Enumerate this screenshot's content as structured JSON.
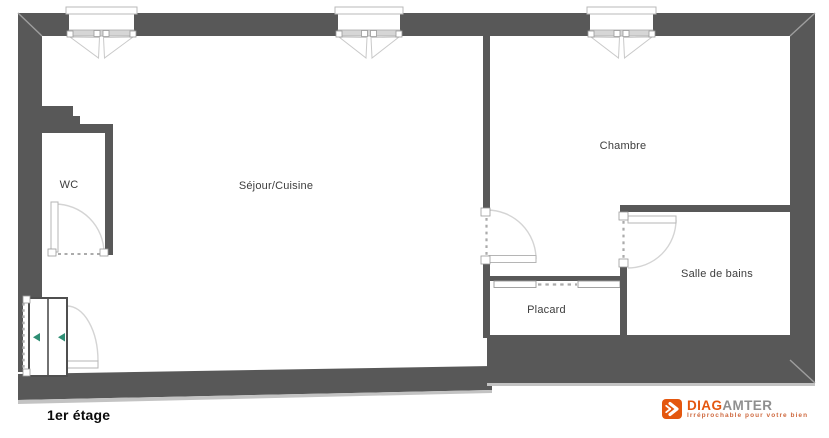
{
  "floor_plan": {
    "floor_label": "1er étage",
    "rooms": [
      {
        "name": "WC"
      },
      {
        "name": "Séjour/Cuisine"
      },
      {
        "name": "Chambre"
      },
      {
        "name": "Placard"
      },
      {
        "name": "Salle de bains"
      }
    ]
  },
  "logo": {
    "icon": "double-chevron-right-icon",
    "brand_part1": "DIAG",
    "brand_part2": "AMTER",
    "tagline": "Irréprochable pour votre bien"
  },
  "colors": {
    "wall": "#585858",
    "wall_bevel": "#9e9e9e",
    "door_swing_line": "#d4d4d4",
    "door_leaf_border": "#b5b5b5",
    "opening_dash": "#ababab",
    "window_bar": "#d6d6d6",
    "entrance_arrow_green": "#2e8e74",
    "room_label_text": "#3d3d3d",
    "brand_orange": "#e4570f",
    "brand_gray": "#8f8f8f",
    "tagline_orange": "#cf6a40"
  }
}
